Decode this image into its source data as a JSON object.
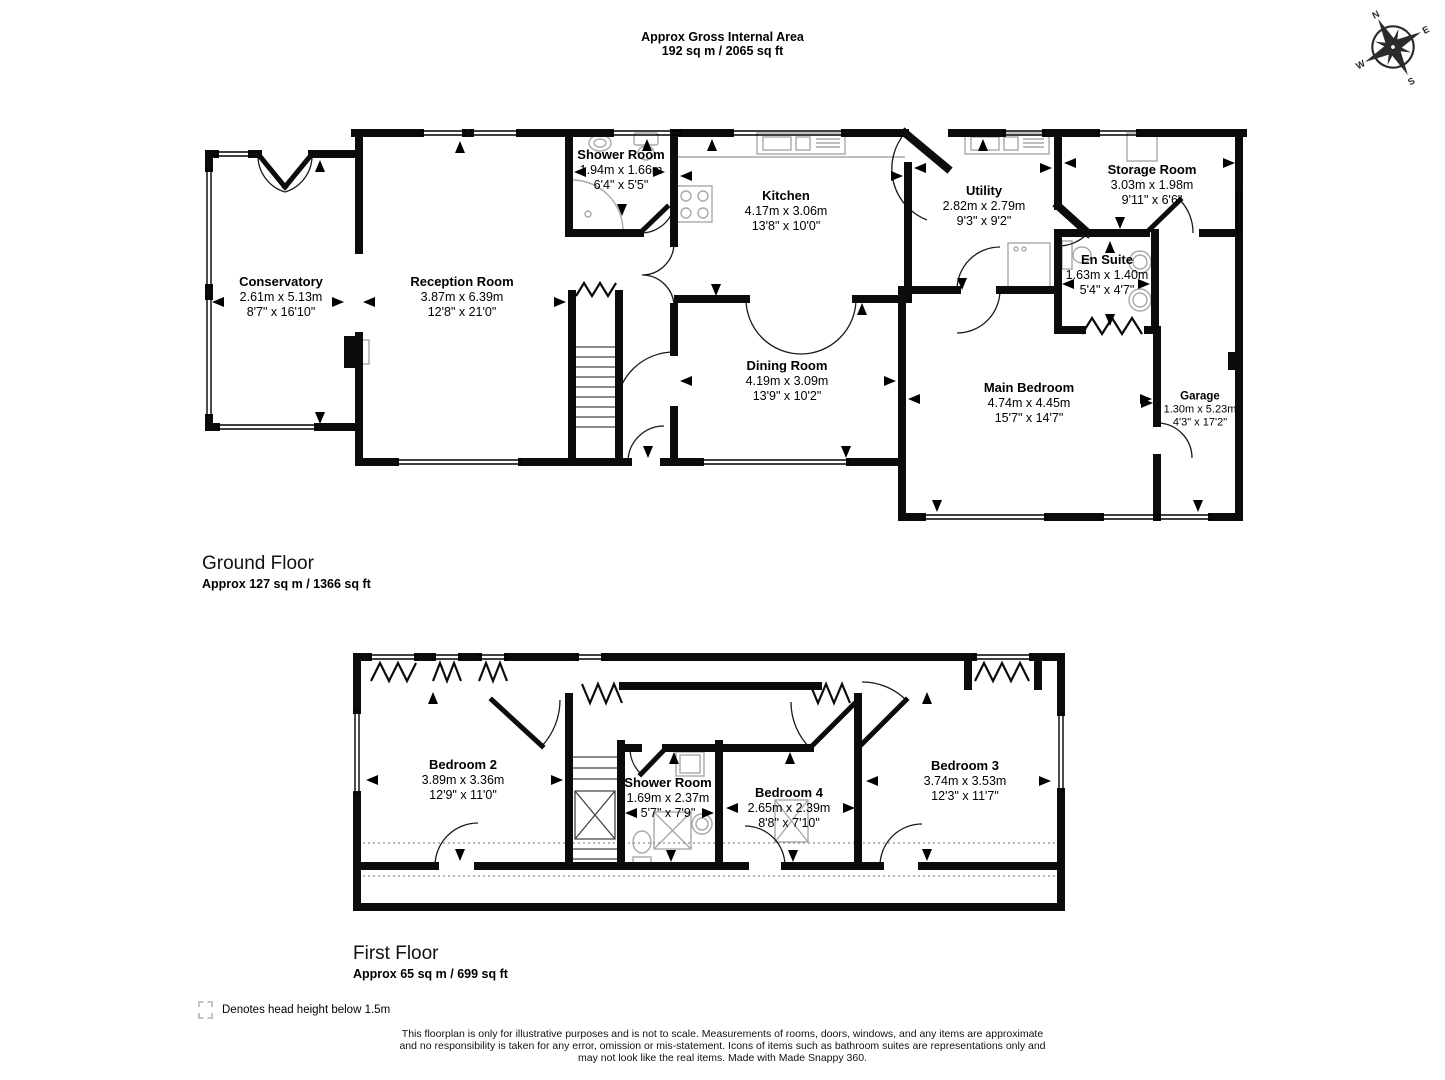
{
  "header": {
    "line1": "Approx Gross Internal Area",
    "line2": "192 sq m / 2065 sq ft"
  },
  "compass": {
    "n": "N",
    "e": "E",
    "s": "S",
    "w": "W"
  },
  "ground_floor": {
    "title": "Ground Floor",
    "area": "Approx 127 sq m / 1366 sq ft",
    "rooms": [
      {
        "name": "Conservatory",
        "metric": "2.61m x 5.13m",
        "imperial": "8'7\" x 16'10\""
      },
      {
        "name": "Reception Room",
        "metric": "3.87m x 6.39m",
        "imperial": "12'8\" x 21'0\""
      },
      {
        "name": "Shower Room",
        "metric": "1.94m x 1.66m",
        "imperial": "6'4\" x 5'5\""
      },
      {
        "name": "Kitchen",
        "metric": "4.17m x 3.06m",
        "imperial": "13'8\" x 10'0\""
      },
      {
        "name": "Utility",
        "metric": "2.82m x 2.79m",
        "imperial": "9'3\" x 9'2\""
      },
      {
        "name": "Storage Room",
        "metric": "3.03m x 1.98m",
        "imperial": "9'11\" x 6'6\""
      },
      {
        "name": "En Suite",
        "metric": "1.63m x 1.40m",
        "imperial": "5'4\" x 4'7\""
      },
      {
        "name": "Dining Room",
        "metric": "4.19m x 3.09m",
        "imperial": "13'9\" x 10'2\""
      },
      {
        "name": "Main Bedroom",
        "metric": "4.74m x 4.45m",
        "imperial": "15'7\" x 14'7\""
      },
      {
        "name": "Garage",
        "metric": "1.30m x 5.23m",
        "imperial": "4'3\" x 17'2\""
      }
    ]
  },
  "first_floor": {
    "title": "First Floor",
    "area": "Approx 65 sq m / 699 sq ft",
    "rooms": [
      {
        "name": "Bedroom 2",
        "metric": "3.89m x 3.36m",
        "imperial": "12'9\" x 11'0\""
      },
      {
        "name": "Shower Room",
        "metric": "1.69m x 2.37m",
        "imperial": "5'7\" x 7'9\""
      },
      {
        "name": "Bedroom 4",
        "metric": "2.65m x 2.39m",
        "imperial": "8'8\" x 7'10\""
      },
      {
        "name": "Bedroom 3",
        "metric": "3.74m x 3.53m",
        "imperial": "12'3\" x 11'7\""
      }
    ]
  },
  "legend": {
    "text": "Denotes head height below 1.5m"
  },
  "disclaimer": {
    "line1": "This floorplan is only for illustrative purposes and is not to scale. Measurements of rooms, doors, windows, and any items are approximate",
    "line2": "and no responsibility is taken for any error, omission or mis-statement. Icons of items such as bathroom suites are representations only and",
    "line3": "may not look like the real items. Made with Made Snappy 360."
  }
}
